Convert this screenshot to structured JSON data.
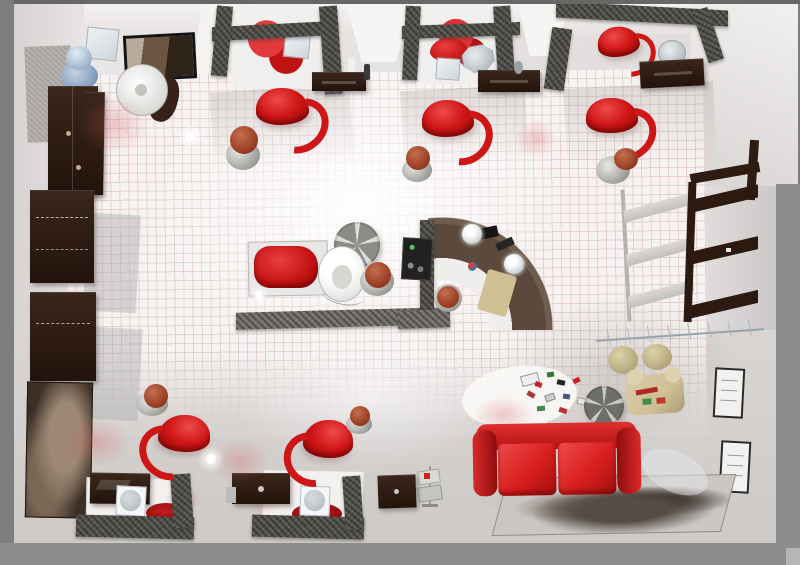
{
  "scene": {
    "description": "3D rendered top-down view of a hair salon interior",
    "objects": [
      "viewport-frame",
      "salon-room",
      "tiled-floor",
      "styling-booth",
      "styling-chair-red",
      "rollabout-stool",
      "shampoo-bench",
      "shampoo-basin",
      "hood-dryer-disc",
      "center-divider-wall",
      "reception-desk-curved",
      "reception-partition",
      "cash-register",
      "desk-lamp",
      "reception-stool",
      "entrance-wardrobe",
      "water-cooler",
      "pedestal-sink",
      "wall-picture",
      "product-shelf",
      "glass-display-panel",
      "large-wall-artwork",
      "right-wall-bookshelf",
      "window-lattice",
      "decor-branch",
      "wall-frame",
      "red-sofa",
      "portrait-rug",
      "round-side-table",
      "beige-armchair",
      "pouf",
      "magazine-clutter",
      "magazine-rack",
      "styling-station-platform",
      "station-partition",
      "station-cabinet",
      "station-mirror",
      "red-floor-mat",
      "ceiling-light-glint"
    ]
  },
  "palette": {
    "frame_gray": "#7d7d7d",
    "frame_top": "#676767",
    "frame_bottom": "#8d8d8d",
    "corner_chip": "#b6b6b6",
    "wall_light": "#f2f0ef",
    "wall_mid": "#dcd9d8",
    "floor_tile": "#f8f5f4",
    "floor_grid": "#e6cfcf",
    "floor_plain": "#d6d3d1",
    "partition_dark": "#56544e",
    "wood_dark": "#22130c",
    "desk_brown": "#5b4a3c",
    "chair_red": "#cf1616",
    "chair_red_dark": "#8e0a0a",
    "sofa_red": "#d81e1e",
    "beige": "#cfc096",
    "cooler_blue": "#8fa6c4",
    "stool_brown": "#9c4026",
    "disc_gray": "#8c8c86",
    "disc_light": "#dcdcd7",
    "rug_gray": "#c9c6c4",
    "sepia_art": "#6b5a47"
  }
}
